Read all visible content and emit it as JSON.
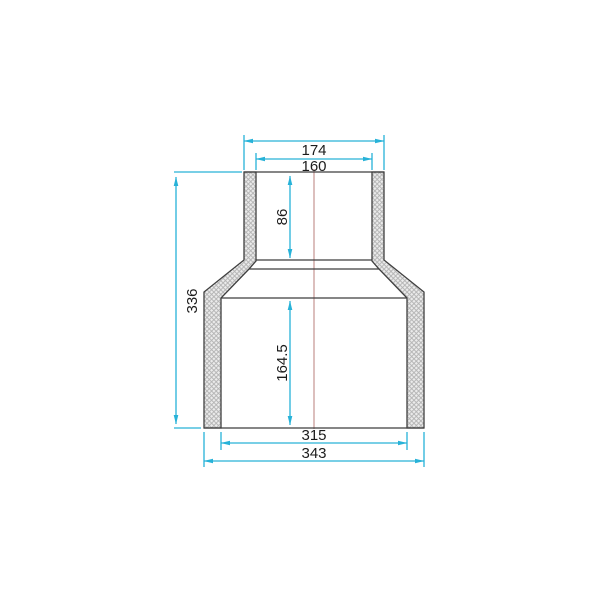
{
  "drawing": {
    "kind": "technical-section-drawing",
    "subject": "concentric reducer pipe fitting, sectioned view with crosshatched walls",
    "dims": {
      "top_outer": "174",
      "top_inner": "160",
      "upper_socket_depth": "86",
      "overall_height": "336",
      "lower_socket_depth": "164.5",
      "bottom_inner": "315",
      "bottom_outer": "343"
    },
    "colors": {
      "dimension": "#27b2d8",
      "outline": "#3f3f3f",
      "centerline": "#dcbfbd",
      "hatch_line": "#b3b3b3",
      "hatch_fill": "#ececec",
      "text": "#1c1c1c",
      "background": "#ffffff"
    }
  }
}
